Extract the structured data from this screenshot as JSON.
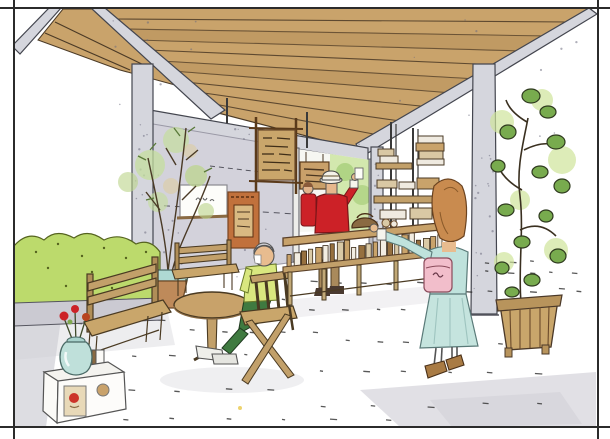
{
  "scene": {
    "kind": "hand-drawn watercolor architectural sketch",
    "description": "Covered cafe/shop terrace under a timber pergola: vendor in red behind a bottle display counter, woman in pale aqua dress browsing, seated customer at a round table, benches, hedges and potted trees, menu boards on a concrete wall, framed by thin black crop lines.",
    "elements": [
      "pergola-ceiling",
      "steel-beams",
      "concrete-posts",
      "back-wall",
      "menu-boards",
      "doorway-opening",
      "vendor-in-red",
      "display-counter",
      "bottle-row",
      "shelving-unit",
      "standing-woman",
      "seated-customer",
      "round-cafe-table",
      "folding-chair",
      "benches",
      "hedge",
      "potted-trees",
      "slatted-planter",
      "flower-vase",
      "display-crate",
      "stone-floor",
      "frame-border"
    ]
  },
  "palette": {
    "paper": "#FFFFFF",
    "frameLine": "#2b2b2b",
    "wood": "#C9A36B",
    "woodDark": "#8a6a42",
    "steel": "#D5D6DD",
    "wall": "#D3D2DB",
    "hedge": "#BCDA6C",
    "leaf": "#78AB4E",
    "leafLight": "#C7E297",
    "foliageSoft": "#C4DD9E",
    "red": "#CC2127",
    "skin": "#E8BC8F",
    "aquaTop": "#BFE2DC",
    "aquaSkirt": "#C5E4DE",
    "pink": "#F2BECB",
    "terracotta": "#BE8A5A",
    "tealPot": "#AFD9D3",
    "furnitureTan": "#C2A06A",
    "shirtYellow": "#D9E77F",
    "pantsGreen": "#3F7A40",
    "orangeBoard": "#C1713C",
    "menuBoard": "#C9A66B",
    "floorShadow": "#DCDBE0"
  },
  "counter": {
    "bottle_count": 22,
    "bottle_colors": [
      "#C9A36B",
      "#F2EDE2",
      "#96703F",
      "#D9C9A6"
    ]
  }
}
